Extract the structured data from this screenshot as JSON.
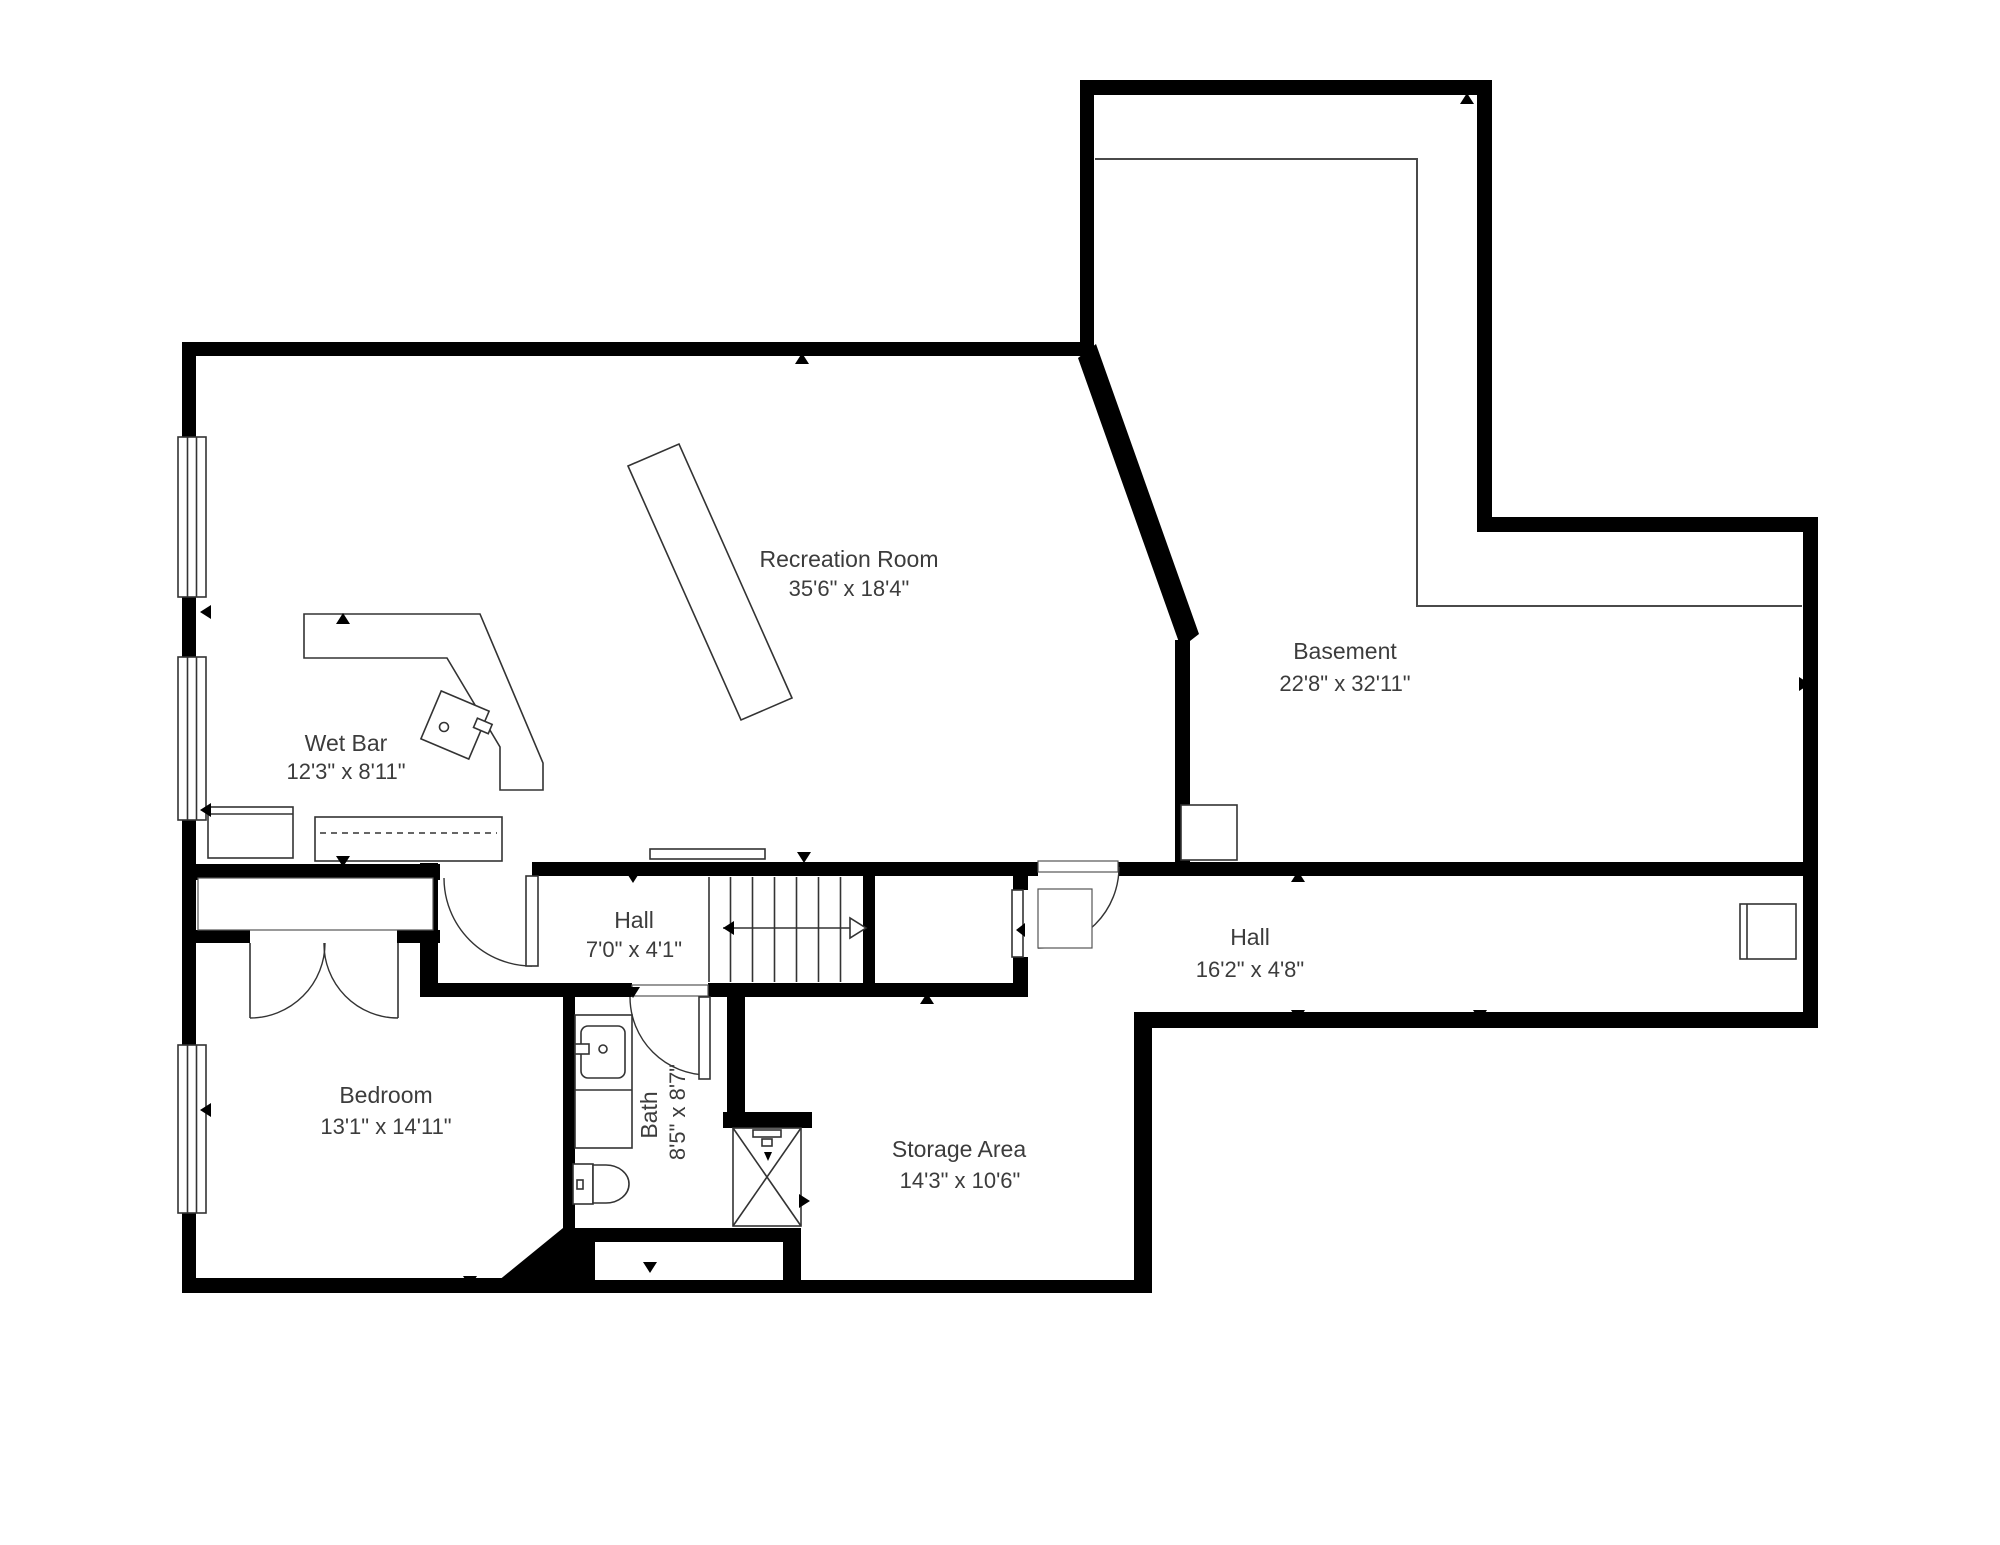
{
  "plan": {
    "type": "basement-floor-plan",
    "background": "#ffffff",
    "wall_color": "#000000",
    "text_color": "#3c3c3c"
  },
  "rooms": {
    "recreation": {
      "name": "Recreation Room",
      "dims": "35'6\" x 18'4\""
    },
    "basement": {
      "name": "Basement",
      "dims": "22'8\" x 32'11\""
    },
    "wetbar": {
      "name": "Wet Bar",
      "dims": "12'3\" x 8'11\""
    },
    "hall_small": {
      "name": "Hall",
      "dims": "7'0\" x 4'1\""
    },
    "hall_long": {
      "name": "Hall",
      "dims": "16'2\" x 4'8\""
    },
    "bedroom": {
      "name": "Bedroom",
      "dims": "13'1\" x 14'11\""
    },
    "bath": {
      "name": "Bath",
      "dims": "8'5\" x 8'7\""
    },
    "storage": {
      "name": "Storage Area",
      "dims": "14'3\" x 10'6\""
    }
  },
  "fixtures": [
    "pool-table",
    "wet-bar-counter",
    "bar-sink",
    "refrigerator",
    "lower-cabinet",
    "stairs",
    "vanity-sink",
    "toilet",
    "shower",
    "closet-double-doors",
    "windows",
    "utility-box",
    "fireplace-box"
  ]
}
